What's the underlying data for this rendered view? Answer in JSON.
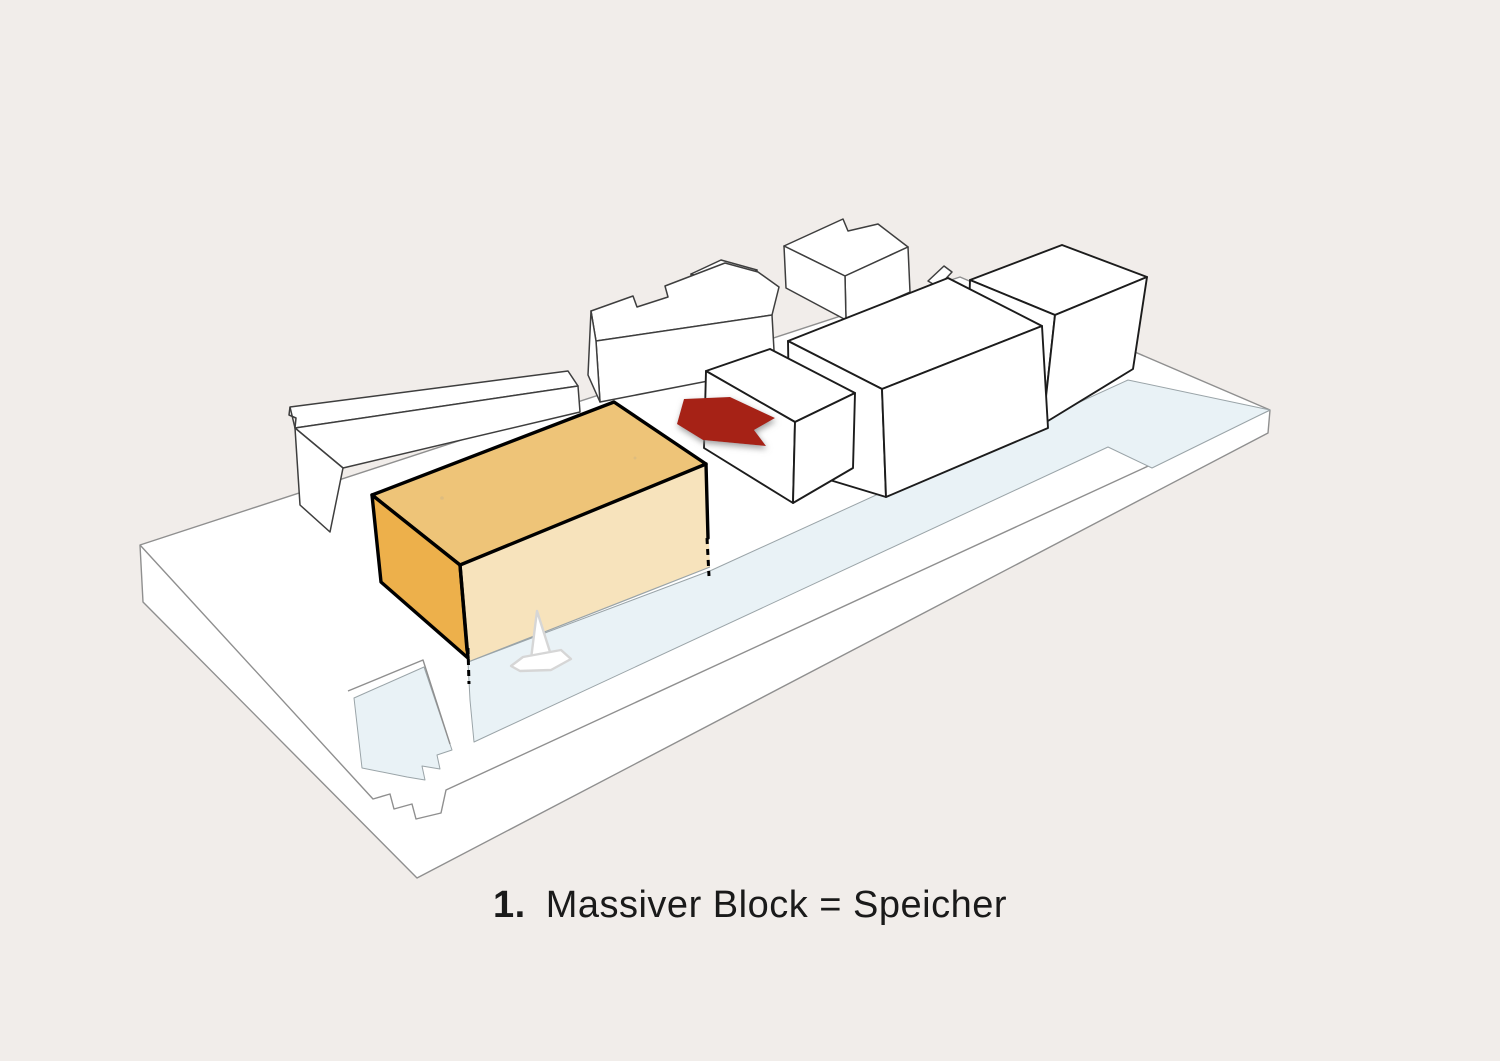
{
  "caption": {
    "number": "1.",
    "label": "Massiver Block = Speicher"
  },
  "icons": {
    "arrow": "direction-arrow",
    "boat": "sailboat-icon"
  },
  "colors": {
    "background": "#f1edea",
    "surface": "#ffffff",
    "line_soft": "#8f8f8f",
    "line_mid": "#3e3e3e",
    "line_strong": "#1c1c1c",
    "water": "#e9f2f6",
    "water_line": "#9aa4a8",
    "block_top": "#eec478",
    "block_side": "#edb04b",
    "block_front": "#f7e3bc",
    "block_line": "#000000",
    "roof_dot": "#d9ba80",
    "arrow": "#a62019",
    "arrow_shadow": "#8d8d8d",
    "boat_line": "#d6d6d6",
    "text": "#1a1a1a"
  }
}
